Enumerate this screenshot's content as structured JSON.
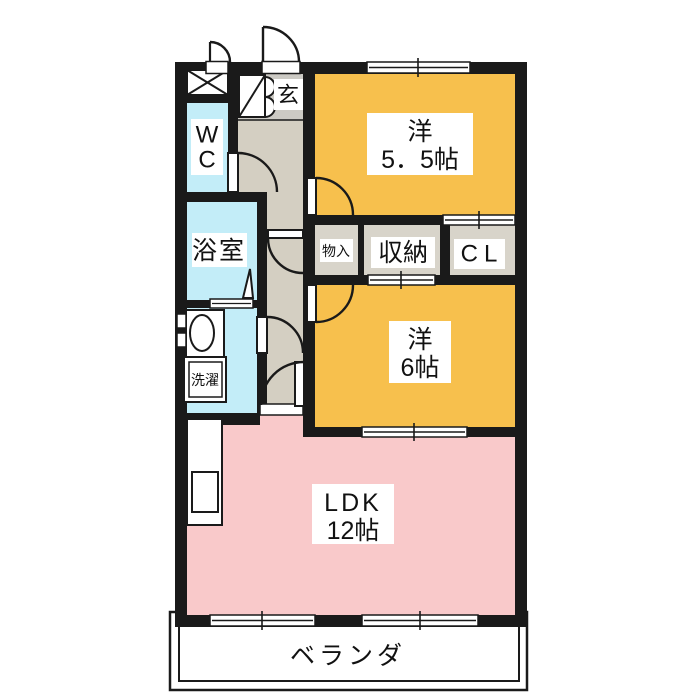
{
  "colors": {
    "wall": "#1a1a1a",
    "western_room": "#f7c04d",
    "ldk": "#f9c9ca",
    "wet_area": "#c3edf8",
    "hall": "#d4cfc2",
    "entrance": "#cccac4",
    "storage": "#d8d4ca"
  },
  "rooms": {
    "western_55": {
      "name": "洋",
      "size": "5．5帖"
    },
    "western_6": {
      "name": "洋",
      "size": "6帖"
    },
    "ldk": {
      "name": "LDK",
      "size": "12帖"
    },
    "bath": {
      "label": "浴室"
    },
    "wc": {
      "line1": "W",
      "line2": "C"
    },
    "laundry": {
      "label": "洗濯"
    },
    "entrance": {
      "label": "玄"
    },
    "small_storage": {
      "label": "物入"
    },
    "storage": {
      "label": "収納"
    },
    "closet": {
      "label": "CL"
    },
    "veranda": {
      "label": "ベランダ"
    }
  }
}
